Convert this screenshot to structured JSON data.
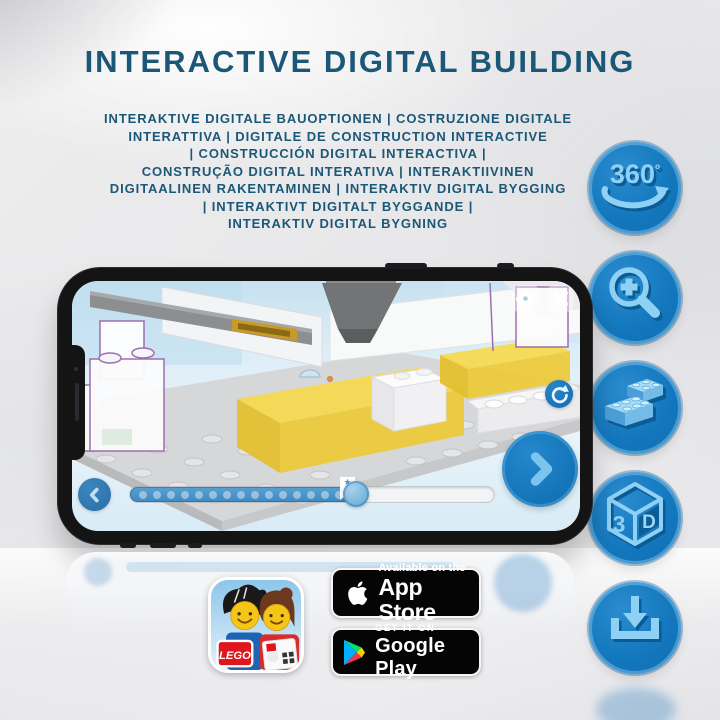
{
  "title": "INTERACTIVE DIGITAL BUILDING",
  "subtitle": {
    "lines": [
      "INTERAKTIVE DIGITALE BAUOPTIONEN | COSTRUZIONE DIGITALE",
      "INTERATTIVA | DIGITALE DE CONSTRUCTION INTERACTIVE",
      "| CONSTRUCCIÓN DIGITAL INTERACTIVA |",
      "CONSTRUÇÃO DIGITAL INTERATIVA | INTERAKTIIVINEN",
      "DIGITAALINEN RAKENTAMINEN | INTERAKTIV DIGITAL BYGGING",
      "| INTERAKTIVT DIGITALT BYGGANDE |",
      "INTERAKTIV DIGITAL BYGNING"
    ]
  },
  "feature_icons": [
    "360-rotation",
    "zoom-in",
    "brick-options",
    "3d-view",
    "download"
  ],
  "icons": {
    "rotate360": {
      "text": "360",
      "degree": "º"
    },
    "cube3d": {
      "three": "3",
      "d": "D"
    }
  },
  "badges": {
    "app_store": {
      "line1": "Available on the",
      "line2": "App Store"
    },
    "google_play": {
      "line1": "GET IT ON",
      "line2": "Google Play"
    }
  },
  "app_icon": {
    "brand": "LEGO"
  },
  "colors": {
    "title_blue": "#1B5878",
    "icon_circle_blue": "#1478BE",
    "icon_glyph_light": "#8ED1F5",
    "icon_glyph_dark": "#0B5B97",
    "screen_blue": "#D9ECF7",
    "control_blue": "#1878BE",
    "progress_blue": "#4E97CD",
    "highlight_yellow": "#F6DA4E",
    "lego_red": "#E1161C",
    "badge_black": "#050505"
  }
}
